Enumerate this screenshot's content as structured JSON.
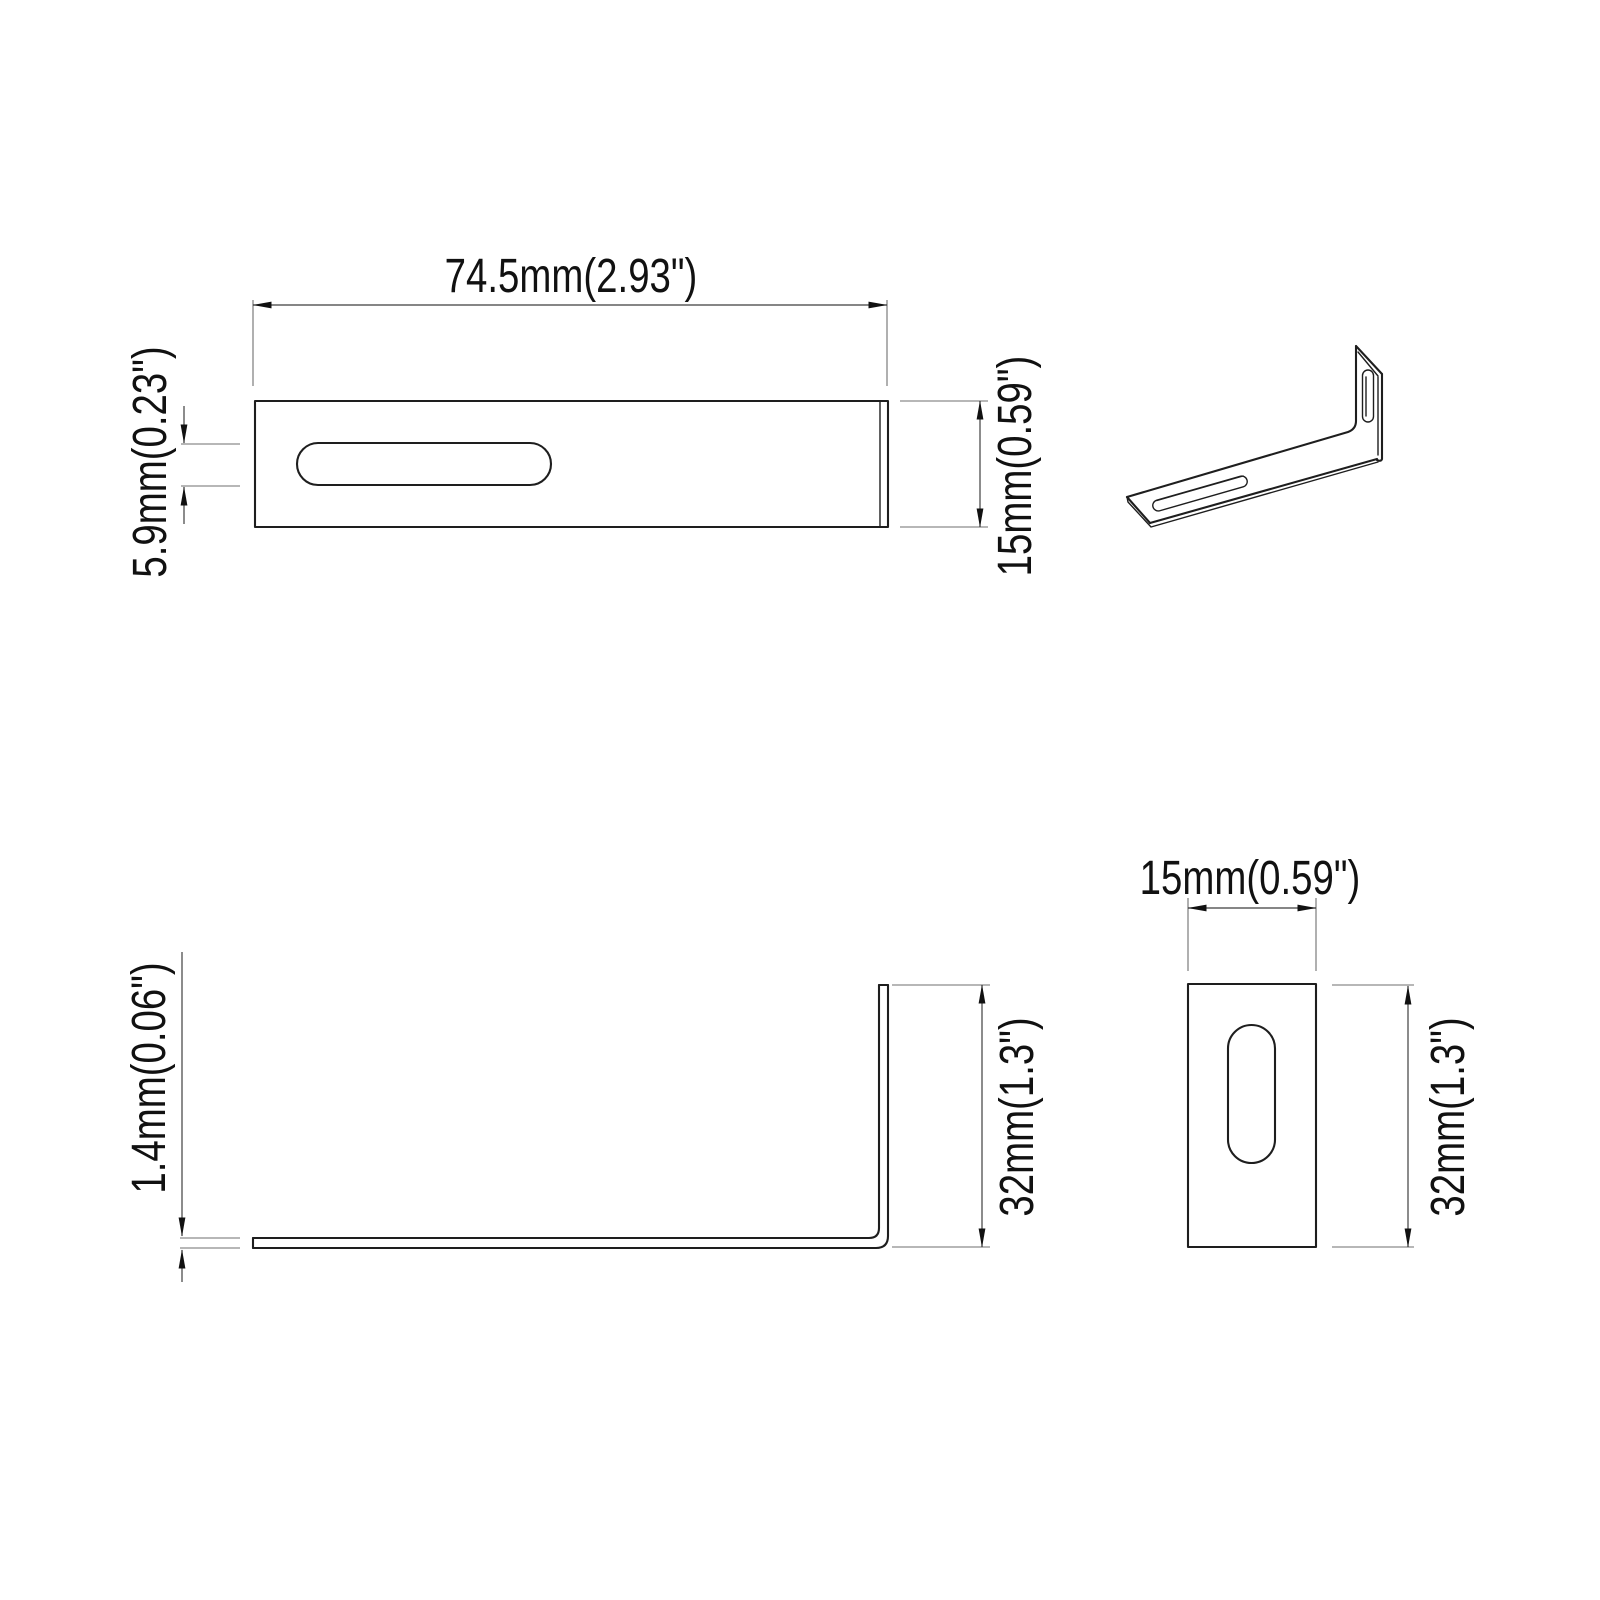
{
  "page": {
    "background": "#ffffff",
    "object_line_color": "#1e1e1e",
    "dimension_line_color": "#3f3f3f",
    "text_color": "#111111"
  },
  "views": {
    "top_view": {
      "width_label": "74.5mm(2.93\")",
      "slot_width_label": "5.9mm(0.23\")",
      "height_label": "15mm(0.59\")"
    },
    "iso_view": {},
    "side_view": {
      "thickness_label": "1.4mm(0.06\")",
      "height_label": "32mm(1.3\")"
    },
    "end_view": {
      "width_label": "15mm(0.59\")",
      "height_label": "32mm(1.3\")"
    }
  }
}
